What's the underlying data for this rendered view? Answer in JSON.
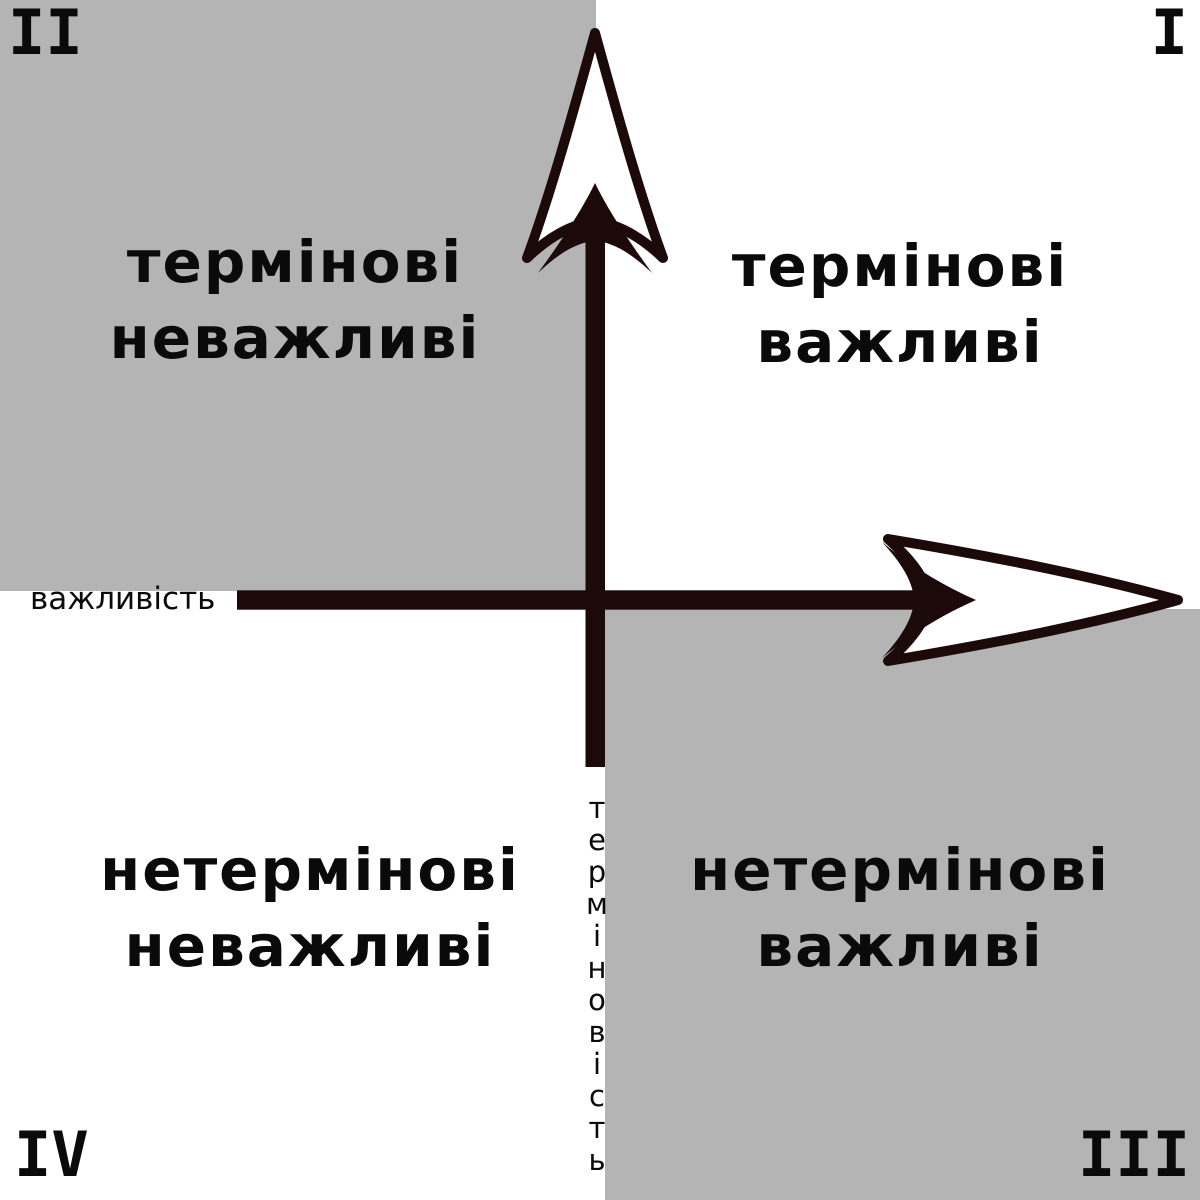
{
  "colors": {
    "quadrant_shade": "#b4b4b4",
    "axis_arrow": "#1c0a0a",
    "text": "#0a0a0a",
    "background": "#ffffff"
  },
  "axes": {
    "x_label": "важливість",
    "y_label": "терміновість"
  },
  "quadrants": {
    "q1": {
      "numeral": "I",
      "line1": "термінові",
      "line2": "важливі",
      "shaded": false,
      "position": "top-right"
    },
    "q2": {
      "numeral": "II",
      "line1": "термінові",
      "line2": "неважливі",
      "shaded": true,
      "position": "top-left"
    },
    "q3": {
      "numeral": "III",
      "line1": "нетермінові",
      "line2": "важливі",
      "shaded": true,
      "position": "bottom-right"
    },
    "q4": {
      "numeral": "IV",
      "line1": "нетермінові",
      "line2": "неважливі",
      "shaded": false,
      "position": "bottom-left"
    }
  }
}
